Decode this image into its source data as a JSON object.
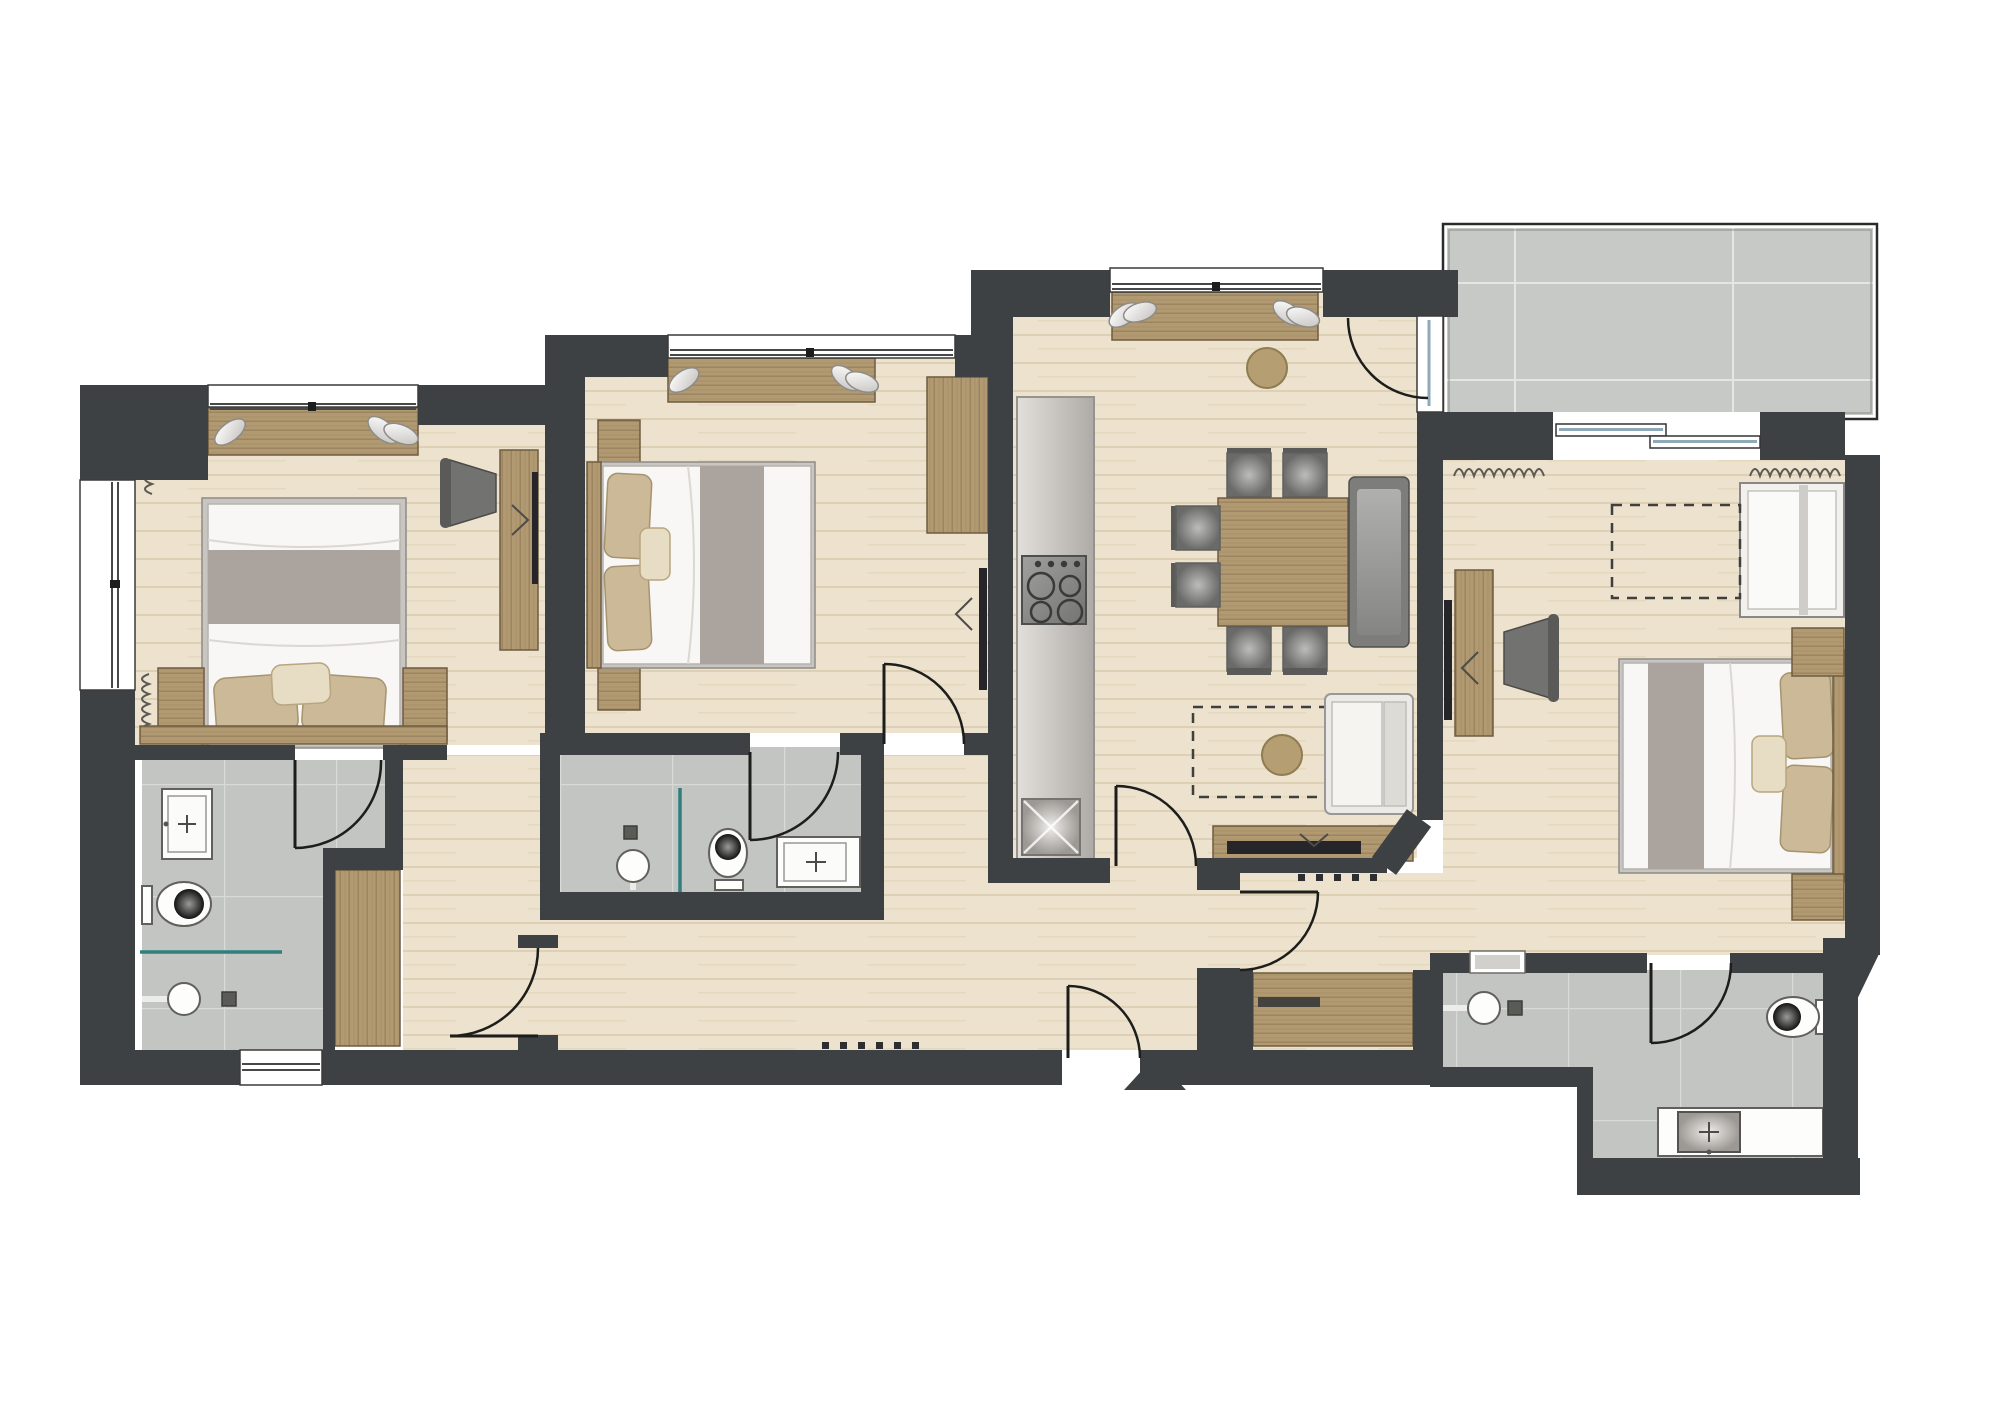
{
  "document": {
    "kind": "architectural floor plan (top-down 2D render of an apartment)",
    "visible_text": "none",
    "canvas": {
      "width": 2000,
      "height": 1400,
      "background": "#ffffff"
    }
  },
  "palette": {
    "wall": "#3e4144",
    "wood_floor": "#ece2cd",
    "wood_floor_grain": "#ddd0b4",
    "tile_floor": "#c2c5c1",
    "tile_grout": "#d8dad6",
    "balcony_tile": "#c6c9c5",
    "furniture_wood": "#b19972",
    "furniture_wood_edge": "#6f5c40",
    "bed_white": "#f8f7f5",
    "blanket_gray": "#aaa39e",
    "pillow_beige": "#cbb998",
    "upholstery_gray": "#8d8d8b",
    "shower_glass_teal": "#2e7f7e",
    "door_line": "#1d1d1b",
    "tv_black": "#26262a"
  },
  "rooms": [
    {
      "id": "bedroom-1",
      "position": "top-left",
      "floor": "wood",
      "furniture": [
        "window-bench with pillows",
        "double bed with gray blanket band",
        "2 beige pillows + accent pillow",
        "headboard board",
        "2 nightstands",
        "dresser with tv",
        "desk chair",
        "2 radiators on left wall"
      ]
    },
    {
      "id": "bathroom-1",
      "position": "bottom-left",
      "floor": "gray tile",
      "fixtures": [
        "vanity sink with tap cross",
        "toilet",
        "teal glass shower screen",
        "shower head with arm",
        "floor drain",
        "window in bottom wall",
        "built-in wardrobe niche"
      ]
    },
    {
      "id": "corridor-bedroom-1",
      "position": "left-center",
      "floor": "wood",
      "fixtures": [
        "door to hall",
        "wardrobe"
      ]
    },
    {
      "id": "bedroom-2",
      "position": "center-left",
      "floor": "wood",
      "furniture": [
        "window-bench with pillows",
        "double bed (head west)",
        "2 nightstands",
        "tall wardrobe NE corner",
        "wall tv facing bed"
      ]
    },
    {
      "id": "bathroom-2",
      "position": "center-bottom",
      "floor": "gray tile",
      "fixtures": [
        "shower with teal glass",
        "shower head",
        "drain",
        "toilet",
        "vanity sink",
        "wall niche"
      ]
    },
    {
      "id": "kitchen-living-dining",
      "position": "center",
      "floor": "wood",
      "furniture": [
        "galley kitchen counter with 4-burner stove and sink",
        "window-bench with 4 pillows",
        "2 round poufs",
        "dining table",
        "6 gray chairs",
        "high-back settee bench",
        "white armchair",
        "dashed rug/furniture outline",
        "sideboard with tv"
      ]
    },
    {
      "id": "entrance-hall",
      "position": "bottom-center",
      "floor": "wood",
      "fixtures": [
        "entrance door with swing arc",
        "triangle entrance marker",
        "threshold dash marks",
        "doors to living room, west corridor and east corridor"
      ]
    },
    {
      "id": "east-corridor",
      "position": "center-right-bottom",
      "floor": "wood",
      "fixtures": [
        "door from hall",
        "built-in wardrobe with shelf"
      ]
    },
    {
      "id": "bedroom-3",
      "position": "right",
      "floor": "wood",
      "furniture": [
        "sliding glass door to balcony",
        "2 radiators",
        "crib / small bed",
        "dashed future-furniture outline",
        "desk unit with tv and chair",
        "double bed (head east)",
        "2 nightstands"
      ]
    },
    {
      "id": "bathroom-3",
      "position": "bottom-right",
      "floor": "gray tile",
      "fixtures": [
        "shower head with arm",
        "drain",
        "interior niche window",
        "door",
        "toilet",
        "vanity counter with sink"
      ]
    },
    {
      "id": "balcony",
      "position": "top-right",
      "floor": "large gray stone tiles",
      "fixtures": [
        "thin railing outline"
      ]
    }
  ],
  "openings": {
    "entrance_doors": 1,
    "interior_hinged_doors": 7,
    "balcony_hinged_door": 1,
    "sliding_glass_door": 1,
    "windows": 6
  },
  "symbols": {
    "radiator": "wavy squiggle line",
    "entrance_marker": "solid dark triangle pointing into flat",
    "planned_furniture": "dashed rectangle",
    "shower_screen": "teal line",
    "door_swing": "quarter-circle arc"
  }
}
